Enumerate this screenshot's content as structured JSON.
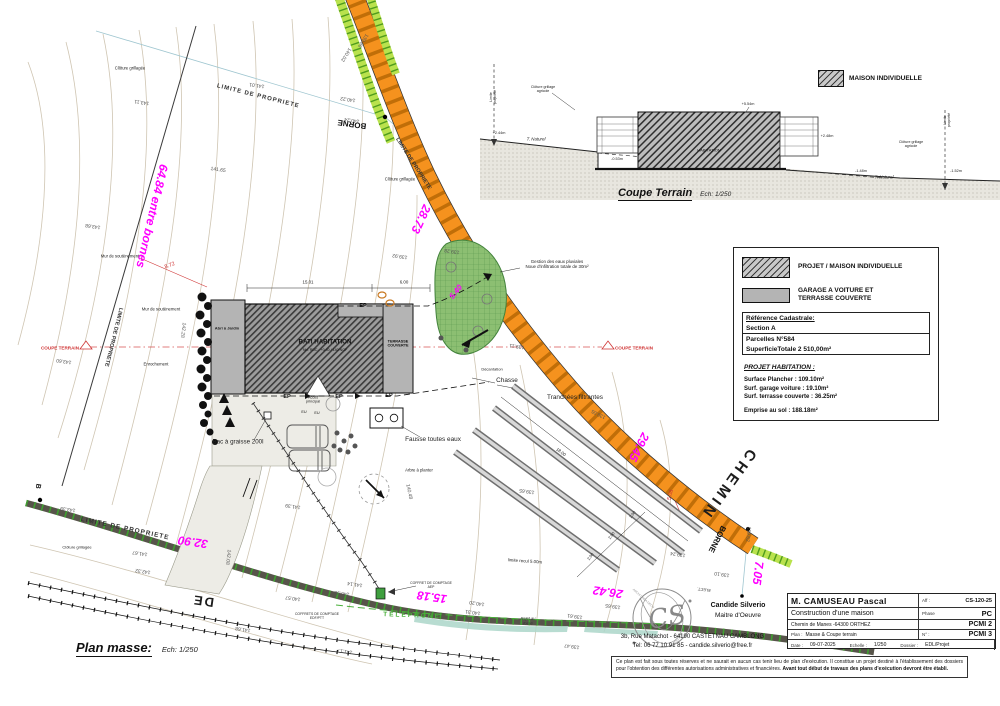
{
  "page": {
    "width": 1000,
    "height": 706
  },
  "plan_title": {
    "label": "Plan masse:",
    "scale": "Ech: 1/250"
  },
  "coupe_title": {
    "label": "Coupe Terrain",
    "scale": "Ech: 1/250"
  },
  "coupe_legend": {
    "label": "MAISON INDIVIDUELLE"
  },
  "legend": {
    "project_label": "PROJET /  MAISON INDIVIDUELLE",
    "garage_label": "GARAGE A VOITURE ET\nTERRASSE COUVERTE",
    "cadastre_title": "Référence Cadastrale:",
    "cadastre_section": "Section A",
    "cadastre_parcel": "Parcelles N°584",
    "cadastre_area": "SuperficieTotale 2 510,00m²",
    "projet_title": "PROJET HABITATION :",
    "surface_plancher": "Surface Plancher : 109.10m²",
    "surface_garage": "Surf. garage voiture : 19.10m²",
    "surface_terrasse": "Surf. terrasse couverte : 36.25m²",
    "emprise": "Emprise au sol : 188.18m²"
  },
  "titleblock": {
    "client": "M. CAMUSEAU Pascal",
    "aff_label": "Aff :",
    "aff_value": "CS-120-25",
    "project": "Construction  d'une maison",
    "phase_label": "Phase",
    "phase_value": "PC",
    "address": "Chemin de Manes -64300 ORTHEZ",
    "pcmi2": "PCMI 2",
    "plan_label": "Plan :",
    "plan_value": "Masse & Coupe terrain",
    "num_label": "N° :",
    "num_value": "PCMI 3",
    "date_label": "Date :",
    "date_value": "09-07-2025",
    "echelle_label": "Echelle :",
    "echelle_value": "1/250",
    "dossier_label": "Dossier :",
    "dossier_value": "EDL/Projet"
  },
  "architect": {
    "name": "Candide Silverio",
    "role": "Maitre d'Oeuvre",
    "address": "3b, Rue  Matachot  -  64190 CASTETNAU CAMBLONG",
    "tel": "Tel: 06 77 10 91 85   -   candide.silverio@free.fr",
    "stamp_initials": "CS"
  },
  "disclaimer": {
    "text": "Ce plan est fait sous toutes réserves et ne saurait en aucun cas tenir lieu de plan d'exécution. Il constitue un projet destiné à l'établissement des dossiers pour l'obtention des différentes autorisations administratives et financières. ",
    "bold": "Avant tout début de travaux des plans d'exécution devront être établi."
  },
  "colors": {
    "dimension_magenta": "#FF00FF",
    "road_orange": "#F5921E",
    "road_hatch": "#C06E08",
    "verge_green": "#B9E24D",
    "noue_green": "#8CBF72",
    "telephone_green": "#49B03A",
    "section_red": "#CF3333",
    "contour_tan": "#CFC5B2",
    "boundary_cyan": "#9FC6D0",
    "hedge_strip_dark": "#57544A",
    "strip_tick_green": "#3F9F30"
  },
  "plan": {
    "labels": [
      {
        "n": "dim-entre-bornes",
        "t": "64.84 entre bornes",
        "x": 152,
        "y": 216,
        "r": 103,
        "s": 12,
        "c": "#FF00FF",
        "w": 1,
        "i": 1
      },
      {
        "n": "dim-28-73",
        "t": "28.73",
        "x": 421,
        "y": 219,
        "r": 115,
        "s": 12,
        "c": "#FF00FF",
        "w": 1,
        "i": 1
      },
      {
        "n": "dim-29-45",
        "t": "29.45",
        "x": 639,
        "y": 447,
        "r": 117,
        "s": 12,
        "c": "#FF00FF",
        "w": 1,
        "i": 1
      },
      {
        "n": "dim-32-90",
        "t": "32.90",
        "x": 193,
        "y": 542,
        "r": 188,
        "s": 12,
        "c": "#FF00FF",
        "w": 1,
        "i": 1
      },
      {
        "n": "dim-15-18",
        "t": "15.18",
        "x": 432,
        "y": 597,
        "r": 188,
        "s": 12,
        "c": "#FF00FF",
        "w": 1,
        "i": 1
      },
      {
        "n": "dim-26-42",
        "t": "26.42",
        "x": 608,
        "y": 592,
        "r": 188,
        "s": 12,
        "c": "#FF00FF",
        "w": 1,
        "i": 1
      },
      {
        "n": "dim-7-05",
        "t": "7.05",
        "x": 758,
        "y": 573,
        "r": 97,
        "s": 12,
        "c": "#FF00FF",
        "w": 1,
        "i": 1
      },
      {
        "n": "dim-5-40",
        "t": "5.40",
        "x": 456,
        "y": 292,
        "r": -52,
        "s": 8,
        "c": "#FF00FF",
        "w": 1,
        "i": 1
      },
      {
        "n": "coupe-terrain-marker-left",
        "t": "COUPE TERRAIN",
        "x": 60,
        "y": 348,
        "s": 4.6,
        "c": "#CF3333",
        "w": 1
      },
      {
        "n": "coupe-terrain-marker-right",
        "t": "COUPE TERRAIN",
        "x": 634,
        "y": 348,
        "s": 4.6,
        "c": "#CF3333",
        "w": 1
      },
      {
        "n": "dim-8-72",
        "t": "8.72",
        "x": 170,
        "y": 266,
        "r": -20,
        "s": 5.5,
        "c": "#CF3333"
      },
      {
        "n": "dim-5-08",
        "t": "5.08",
        "x": 671,
        "y": 495,
        "r": -75,
        "s": 5.5,
        "c": "#CF3333"
      },
      {
        "n": "road-name-chemin",
        "t": "CHEMIN",
        "x": 728,
        "y": 484,
        "r": 126,
        "s": 15,
        "c": "#1c1c1c",
        "w": 1,
        "ls": 4
      },
      {
        "n": "road-name-de",
        "t": "DE",
        "x": 203,
        "y": 601,
        "r": 188,
        "s": 13,
        "c": "#1c1c1c",
        "w": 1,
        "ls": 2
      },
      {
        "n": "borne-top",
        "t": "BORNE",
        "x": 352,
        "y": 124,
        "r": 188,
        "s": 8,
        "c": "#111",
        "w": 1
      },
      {
        "n": "borne-bottom",
        "t": "BORNE",
        "x": 717,
        "y": 539,
        "r": 117,
        "s": 8,
        "c": "#111",
        "w": 1
      },
      {
        "n": "borne-left",
        "t": "B",
        "x": 37,
        "y": 486,
        "r": 100,
        "s": 7,
        "c": "#111",
        "w": 1
      },
      {
        "n": "limite-propriete-top",
        "t": "LIMITE DE PROPRIETE",
        "x": 258,
        "y": 97,
        "r": 14,
        "s": 6,
        "c": "#333",
        "w": 1,
        "ls": 1
      },
      {
        "n": "limite-propriete-left",
        "t": "LIMITE DE PROPRIETE",
        "x": 113,
        "y": 337,
        "r": 104,
        "s": 5.5,
        "c": "#333",
        "w": 1
      },
      {
        "n": "limite-propriete-road",
        "t": "LIMITE DE PROPRIETE",
        "x": 413,
        "y": 164,
        "r": 57,
        "s": 5.5,
        "c": "#333",
        "w": 1
      },
      {
        "n": "limite-propriete-bottom",
        "t": "LIMITE DE PROPRIETE",
        "x": 125,
        "y": 529,
        "r": 12,
        "s": 6.5,
        "c": "#333",
        "w": 1,
        "ls": 1
      },
      {
        "n": "cloture-grillagee-top",
        "t": "Clôture grillagée",
        "x": 130,
        "y": 69,
        "s": 4.2
      },
      {
        "n": "cloture-grillagee-mid",
        "t": "Clôture grillagée",
        "x": 400,
        "y": 180,
        "s": 4.2
      },
      {
        "n": "cloture-grillagee-bottom",
        "t": "Clôture grillagée",
        "x": 77,
        "y": 548,
        "s": 4
      },
      {
        "n": "mur-soutenement-1",
        "t": "Mur de soutènement",
        "x": 120,
        "y": 257,
        "s": 4.2
      },
      {
        "n": "mur-soutenement-2",
        "t": "Mur de soutènement",
        "x": 161,
        "y": 310,
        "s": 4.2
      },
      {
        "n": "enrochement",
        "t": "Enrochement",
        "x": 156,
        "y": 365,
        "s": 4.2
      },
      {
        "n": "abri-jardin",
        "t": "Abri à Jardin",
        "x": 227,
        "y": 329,
        "s": 4,
        "w": 1
      },
      {
        "n": "bati-habitation",
        "t": "BATI HABITATION",
        "x": 325,
        "y": 342,
        "s": 6.2,
        "c": "#111",
        "w": 1
      },
      {
        "n": "bati-niveau",
        "t": "Niv. RDC : +0.40 / 140 NGF",
        "x": 325,
        "y": 350,
        "s": 3.6,
        "c": "#111"
      },
      {
        "n": "terrasse-couverte",
        "t": "TERRASSE\nCOUVERTE",
        "x": 398,
        "y": 344,
        "s": 3.8,
        "c": "#111",
        "w": 1
      },
      {
        "n": "gestion-eaux-pluviales",
        "t": "Gestion des eaux pluviales\nNoue d'infiltration totale de 30m²",
        "x": 557,
        "y": 264,
        "s": 4.4
      },
      {
        "n": "decantation",
        "t": "Décantation",
        "x": 492,
        "y": 370,
        "s": 4
      },
      {
        "n": "chasse",
        "t": "Chasse",
        "x": 507,
        "y": 381,
        "s": 6.4
      },
      {
        "n": "tranchees-filtrantes",
        "t": "Tranchées filtrantes",
        "x": 575,
        "y": 398,
        "s": 6.4
      },
      {
        "n": "fosse-toutes-eaux",
        "t": "Fausse toutes eaux",
        "x": 433,
        "y": 440,
        "s": 6.4
      },
      {
        "n": "arbre-a-planter",
        "t": "Arbre à planter",
        "x": 419,
        "y": 471,
        "s": 4.2
      },
      {
        "n": "bac-a-graisse",
        "t": "Bac à graisse 200l",
        "x": 238,
        "y": 442,
        "s": 6.2
      },
      {
        "n": "acces-principal",
        "t": "Accès\nprincipal",
        "x": 313,
        "y": 400,
        "s": 3.8
      },
      {
        "n": "coffret-comptage-aep",
        "t": "COFFRET DE COMPTAGE\nAEP",
        "x": 431,
        "y": 585,
        "s": 3.4
      },
      {
        "n": "coffrets-comptage-edf",
        "t": "COFFRETS DE COMPTAGE\nEDF/PTT",
        "x": 317,
        "y": 616,
        "s": 3.4
      },
      {
        "n": "rejet-au-fosse",
        "t": "Rejet au\nfossé",
        "x": 528,
        "y": 621,
        "s": 4,
        "c": "#333",
        "i": 1
      },
      {
        "n": "telephone",
        "t": "TELEPHONE",
        "x": 412,
        "y": 616,
        "r": 2,
        "s": 6.5,
        "c": "#49B03A",
        "w": 1,
        "ls": 2
      },
      {
        "n": "limite-recul",
        "t": "limite recul 5.00m",
        "x": 525,
        "y": 561,
        "r": 4,
        "s": 4.4
      },
      {
        "n": "elect",
        "t": "ELECT.",
        "x": 704,
        "y": 589,
        "r": 188,
        "s": 4,
        "c": "#333"
      },
      {
        "n": "ep-1",
        "t": "EP",
        "x": 287,
        "y": 397,
        "s": 5.5,
        "c": "#111",
        "w": 1
      },
      {
        "n": "ep-2",
        "t": "EP",
        "x": 339,
        "y": 397,
        "s": 5.5,
        "c": "#111",
        "w": 1
      },
      {
        "n": "ep-3",
        "t": "EP",
        "x": 389,
        "y": 396,
        "s": 5.5,
        "c": "#111",
        "w": 1
      },
      {
        "n": "ep-4",
        "t": "EP",
        "x": 363,
        "y": 306,
        "s": 5.5,
        "c": "#111",
        "w": 1
      },
      {
        "n": "eu-1",
        "t": "EU",
        "x": 304,
        "y": 412,
        "s": 3.8,
        "c": "#111"
      },
      {
        "n": "eu-2",
        "t": "EU",
        "x": 317,
        "y": 413,
        "s": 3.8,
        "c": "#111"
      },
      {
        "n": "dim-15-01",
        "t": "15.01",
        "x": 308,
        "y": 282,
        "s": 4.4
      },
      {
        "n": "dim-6-00",
        "t": "6.00",
        "x": 404,
        "y": 282,
        "s": 4.4
      },
      {
        "n": "dim-18-00",
        "t": "18.00",
        "x": 561,
        "y": 452,
        "r": 37,
        "s": 4.4
      },
      {
        "n": "dim-2-00-a",
        "t": "2.00",
        "x": 633,
        "y": 515,
        "r": -52,
        "s": 4
      },
      {
        "n": "dim-2-00-b",
        "t": "2.00",
        "x": 612,
        "y": 536,
        "r": -52,
        "s": 4
      },
      {
        "n": "dim-2-00-c",
        "t": "2.00",
        "x": 591,
        "y": 557,
        "r": -52,
        "s": 4
      },
      {
        "n": "contour-143-11",
        "t": "143.11",
        "x": 142,
        "y": 101,
        "r": 188,
        "s": 5,
        "c": "#555"
      },
      {
        "n": "contour-141-01",
        "t": "141.01",
        "x": 257,
        "y": 84,
        "r": 188,
        "s": 5,
        "c": "#555"
      },
      {
        "n": "contour-140-22",
        "t": "140.22",
        "x": 348,
        "y": 98,
        "r": 188,
        "s": 5,
        "c": "#555"
      },
      {
        "n": "contour-140-24",
        "t": "140.24",
        "x": 352,
        "y": 119,
        "r": 188,
        "s": 5,
        "c": "#555"
      },
      {
        "n": "contour-140-02",
        "t": "140.02",
        "x": 345,
        "y": 54,
        "r": 122,
        "s": 5,
        "c": "#555"
      },
      {
        "n": "contour-139-86",
        "t": "139.86",
        "x": 362,
        "y": 40,
        "r": 122,
        "s": 5,
        "c": "#555"
      },
      {
        "n": "contour-141-65",
        "t": "141.65",
        "x": 218,
        "y": 171,
        "r": 8,
        "s": 5,
        "c": "#555"
      },
      {
        "n": "contour-143-68",
        "t": "143.68",
        "x": 93,
        "y": 225,
        "r": 188,
        "s": 5,
        "c": "#555"
      },
      {
        "n": "contour-143-60",
        "t": "143.60",
        "x": 64,
        "y": 360,
        "r": 188,
        "s": 5,
        "c": "#555"
      },
      {
        "n": "contour-142-28",
        "t": "142.28",
        "x": 182,
        "y": 330,
        "r": 97,
        "s": 5,
        "c": "#555"
      },
      {
        "n": "contour-139-92",
        "t": "139.92",
        "x": 400,
        "y": 255,
        "r": 188,
        "s": 5,
        "c": "#555"
      },
      {
        "n": "contour-139-28",
        "t": "139.28",
        "x": 452,
        "y": 250,
        "r": 188,
        "s": 5,
        "c": "#555"
      },
      {
        "n": "contour-139-11",
        "t": "139.11",
        "x": 517,
        "y": 345,
        "r": 188,
        "s": 5,
        "c": "#555"
      },
      {
        "n": "contour-139-05",
        "t": "139.05",
        "x": 599,
        "y": 413,
        "r": 207,
        "s": 5,
        "c": "#555"
      },
      {
        "n": "contour-139-65",
        "t": "139.65",
        "x": 527,
        "y": 490,
        "r": 188,
        "s": 5,
        "c": "#555"
      },
      {
        "n": "contour-140-48",
        "t": "140.48",
        "x": 408,
        "y": 492,
        "r": 78,
        "s": 5,
        "c": "#555"
      },
      {
        "n": "contour-141-39",
        "t": "141.39",
        "x": 293,
        "y": 505,
        "r": 188,
        "s": 5,
        "c": "#555"
      },
      {
        "n": "contour-143-39",
        "t": "143.39",
        "x": 68,
        "y": 508,
        "r": 188,
        "s": 5,
        "c": "#555"
      },
      {
        "n": "contour-141-67",
        "t": "141.67",
        "x": 140,
        "y": 552,
        "r": 188,
        "s": 5,
        "c": "#555"
      },
      {
        "n": "contour-142-32",
        "t": "142.32",
        "x": 143,
        "y": 570,
        "r": 188,
        "s": 5,
        "c": "#555"
      },
      {
        "n": "contour-142-08",
        "t": "142.08",
        "x": 227,
        "y": 557,
        "r": 97,
        "s": 5,
        "c": "#555"
      },
      {
        "n": "contour-140-57",
        "t": "140.57",
        "x": 293,
        "y": 597,
        "r": 188,
        "s": 5,
        "c": "#555"
      },
      {
        "n": "contour-141-68",
        "t": "141.68",
        "x": 243,
        "y": 628,
        "r": 188,
        "s": 5,
        "c": "#555"
      },
      {
        "n": "contour-141-17",
        "t": "141.17",
        "x": 345,
        "y": 650,
        "r": 188,
        "s": 5,
        "c": "#555"
      },
      {
        "n": "contour-141-14",
        "t": "141.14",
        "x": 355,
        "y": 583,
        "r": 188,
        "s": 5,
        "c": "#555"
      },
      {
        "n": "contour-140-98",
        "t": "140.98",
        "x": 342,
        "y": 592,
        "r": 188,
        "s": 5,
        "c": "#555"
      },
      {
        "n": "contour-140-31",
        "t": "140.31",
        "x": 473,
        "y": 611,
        "r": 188,
        "s": 5,
        "c": "#555"
      },
      {
        "n": "contour-140-20",
        "t": "140.20",
        "x": 477,
        "y": 602,
        "r": 188,
        "s": 5,
        "c": "#555"
      },
      {
        "n": "contour-139-61",
        "t": "139.61",
        "x": 575,
        "y": 615,
        "r": 188,
        "s": 5,
        "c": "#555"
      },
      {
        "n": "contour-139-65-b",
        "t": "139.65",
        "x": 613,
        "y": 605,
        "r": 188,
        "s": 5,
        "c": "#555"
      },
      {
        "n": "contour-139-47",
        "t": "139.47",
        "x": 572,
        "y": 645,
        "r": 188,
        "s": 5,
        "c": "#555"
      },
      {
        "n": "contour-139-52",
        "t": "139.52",
        "x": 747,
        "y": 534,
        "r": 97,
        "s": 5,
        "c": "#555"
      },
      {
        "n": "contour-139-24",
        "t": "139.24",
        "x": 678,
        "y": 553,
        "r": 188,
        "s": 5,
        "c": "#555"
      },
      {
        "n": "contour-139-10",
        "t": "139.10",
        "x": 722,
        "y": 573,
        "r": 188,
        "s": 5,
        "c": "#555"
      },
      {
        "n": "coupe-t-naturel-left",
        "t": "T. Naturel",
        "x": 536,
        "y": 139,
        "s": 4.4,
        "i": 1
      },
      {
        "n": "coupe-t-naturel-right",
        "t": "T. Naturel",
        "x": 884,
        "y": 177,
        "s": 4.4,
        "i": 1
      },
      {
        "n": "coupe-level-244",
        "t": "+2.44m",
        "x": 499,
        "y": 133,
        "s": 3.8
      },
      {
        "n": "coupe-level-248",
        "t": "+2.48m",
        "x": 827,
        "y": 136,
        "s": 3.8
      },
      {
        "n": "coupe-level-554",
        "t": "+5.54m",
        "x": 748,
        "y": 104,
        "s": 3.8
      },
      {
        "n": "coupe-level-053",
        "t": "-0.53m",
        "x": 617,
        "y": 159,
        "s": 3.8
      },
      {
        "n": "coupe-level-148",
        "t": "-1.48m",
        "x": 861,
        "y": 171,
        "s": 3.8
      },
      {
        "n": "coupe-level-152",
        "t": "-1.52m",
        "x": 956,
        "y": 171,
        "s": 3.8
      },
      {
        "n": "coupe-cloture-left",
        "t": "Clôture grillage\nagricole",
        "x": 543,
        "y": 89,
        "s": 3.6
      },
      {
        "n": "coupe-cloture-right",
        "t": "Clôture grillage\nagricole",
        "x": 911,
        "y": 144,
        "s": 3.6
      },
      {
        "n": "coupe-limite-left",
        "t": "Limite\npropriété",
        "x": 493,
        "y": 97,
        "r": -90,
        "s": 3.6
      },
      {
        "n": "coupe-limite-right",
        "t": "Limite\npropriété",
        "x": 947,
        "y": 120,
        "r": -90,
        "s": 3.6
      },
      {
        "n": "coupe-habitation",
        "t": "HABITATION",
        "x": 709,
        "y": 151,
        "s": 4,
        "c": "#111"
      },
      {
        "n": "stamp-atelier",
        "t": "ATELIER",
        "x": 678,
        "y": 639,
        "r": -55,
        "s": 3.5,
        "c": "#999"
      },
      {
        "n": "stamp-archi-crea",
        "t": "ARCHI CREA DECO",
        "x": 643,
        "y": 599,
        "r": 42,
        "s": 3,
        "c": "#999"
      }
    ]
  }
}
